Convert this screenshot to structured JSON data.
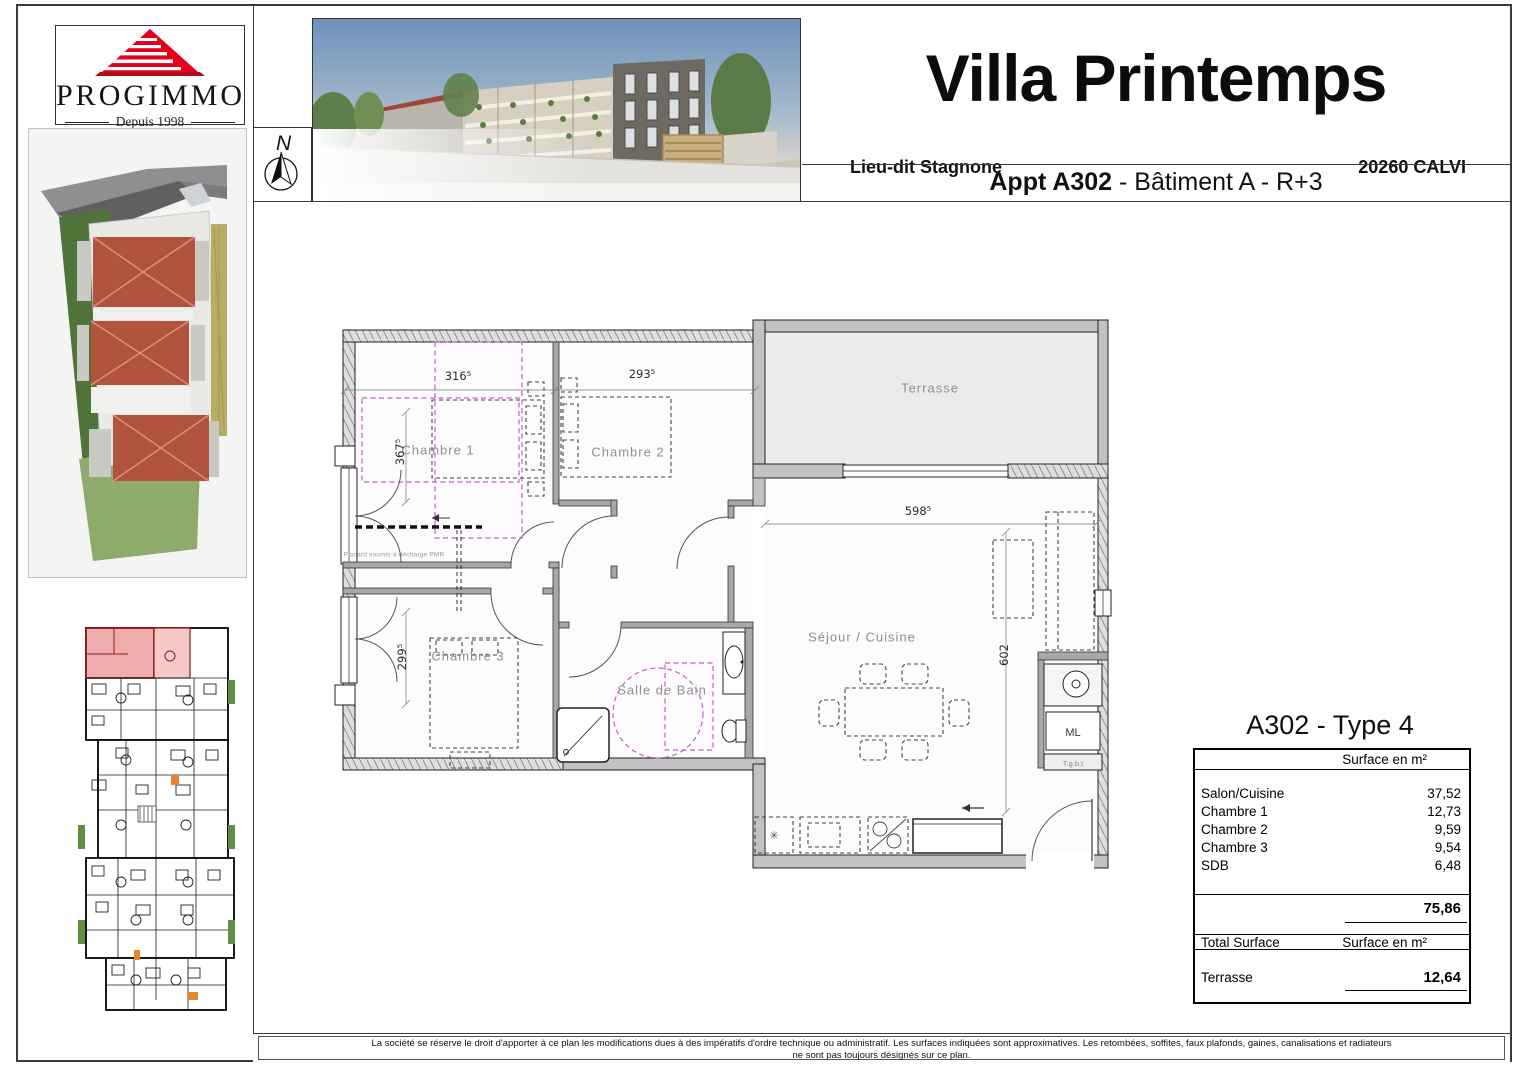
{
  "branding": {
    "name": "PROGIMMO",
    "tagline": "Depuis 1998"
  },
  "compass": {
    "label": "N"
  },
  "header": {
    "title": "Villa Printemps",
    "location_left": "Lieu-dit Stagnone",
    "location_right": "20260 CALVI",
    "apartment": "Appt A302",
    "apartment_suffix": " - Bâtiment A - R+3"
  },
  "plan": {
    "labels": {
      "terrasse": "Terrasse",
      "chambre1": "Chambre 1",
      "chambre2": "Chambre 2",
      "chambre3": "Chambre 3",
      "salle_de_bain": "Salle de Bain",
      "sejour_cuisine": "Séjour / Cuisine",
      "ml": "ML",
      "tgbt": "T.g.b.t",
      "placard": "Placard soumis à décharge PMR"
    },
    "dims": {
      "chambre1_width": "316⁵",
      "chambre2_width": "293⁵",
      "chambre1_depth": "367⁵",
      "chambre3_depth": "299⁵",
      "sejour_width": "598⁵",
      "sejour_depth": "602"
    },
    "colors": {
      "pmr_magenta": "#c45ec4",
      "wall_gray": "#c2c2c2"
    }
  },
  "surface_table": {
    "title": "A302 - Type 4",
    "col_header": "Surface en m²",
    "rows": [
      {
        "label": "Salon/Cuisine",
        "value": "37,52"
      },
      {
        "label": "Chambre 1",
        "value": "12,73"
      },
      {
        "label": "Chambre 2",
        "value": "9,59"
      },
      {
        "label": "Chambre 3",
        "value": "9,54"
      },
      {
        "label": "SDB",
        "value": "6,48"
      }
    ],
    "subtotal": "75,86",
    "total_label": "Total Surface",
    "total_col_header": "Surface en m²",
    "terrace_label": "Terrasse",
    "terrace_value": "12,64"
  },
  "key_plan": {
    "highlight_color": "#eeacac"
  },
  "footer": {
    "line1": "La société se réserve le droit d'apporter à ce plan les modifications dues à des impératifs d'ordre technique ou administratif. Les surfaces indiquées sont approximatives. Les retombées, soffites, faux plafonds, gaines, canalisations et radiateurs",
    "line2": "ne sont pas toujours désignés sur ce plan."
  }
}
